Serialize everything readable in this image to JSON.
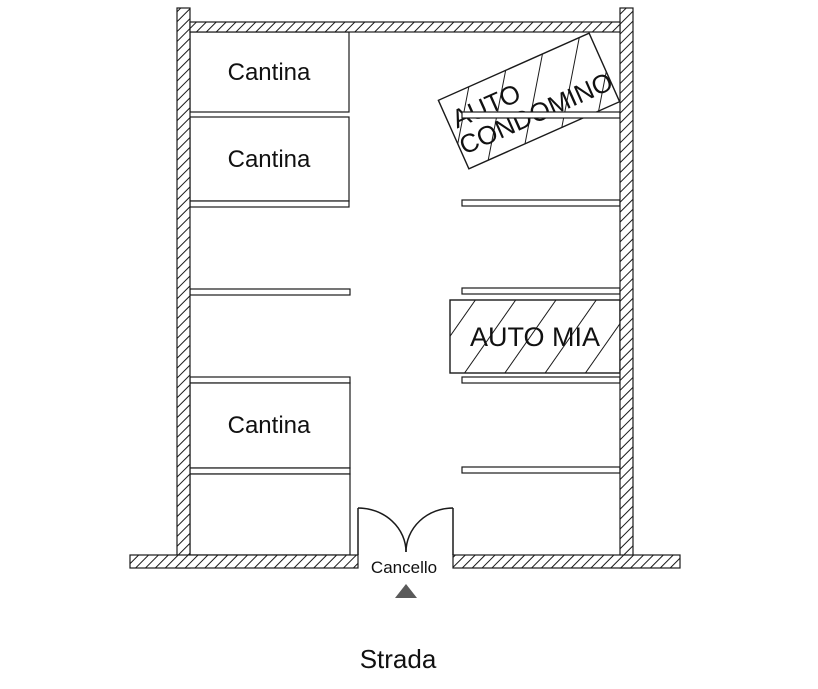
{
  "plan": {
    "storage_rooms": [
      {
        "label": "Cantina"
      },
      {
        "label": "Cantina"
      },
      {
        "label": "Cantina"
      }
    ],
    "condo_car": {
      "line1": "AUTO",
      "line2": "CONDOMINO"
    },
    "my_car": {
      "label": "AUTO MIA"
    },
    "gate": {
      "label": "Cancello"
    },
    "road": {
      "label": "Strada"
    },
    "colors": {
      "line": "#1a1a1a",
      "background": "#ffffff",
      "arrow": "#5a5a5a"
    }
  }
}
